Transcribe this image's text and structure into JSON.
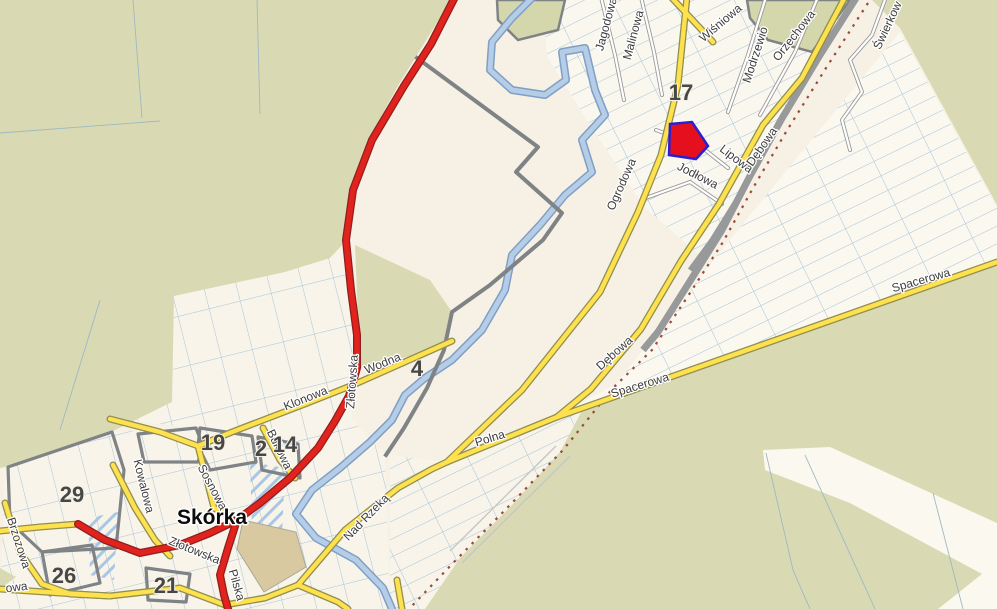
{
  "map": {
    "town": "Skórka",
    "streets": {
      "jagodowa": "Jagodowa",
      "malinowa": "Malinowa",
      "wisniowa": "Wiśniowa",
      "modrzewiowa": "Modrzewio",
      "orzechowa": "Orzechowa",
      "swierkowa": "Świerkow",
      "ogrodowa_upper": "Ogrodowa",
      "ogrodowa_lower": "Ogrodowa",
      "jodlowa": "Jodłowa",
      "lipowa": "Lipowa",
      "debowa_upper": "Dębowa",
      "debowa_lower": "Dębowa",
      "spacerowa_upper": "Spacerowa",
      "spacerowa_lower": "Spacerowa",
      "polna": "Polna",
      "nad_rzeka": "Nad Rzeką",
      "wodna": "Wodna",
      "klonowa": "Klonowa",
      "zlotowska_upper": "Złotowska",
      "zlotowska_lower": "Złotowska",
      "pilska": "Pilska",
      "kowalowa": "Kowalowa",
      "sosnowa": "Sosnowa",
      "bukowa": "Bukowa",
      "brzozowa": "Brzozowa",
      "partial_owa": "owa"
    },
    "area_numbers": {
      "n17": "17",
      "n4": "4",
      "n19": "19",
      "n2": "2",
      "n14": "14",
      "n29": "29",
      "n26": "26",
      "n21": "21"
    },
    "highlighted_parcel": {
      "fill": "#e60f1e",
      "stroke": "#2b1fd4"
    },
    "colors": {
      "background": "#f6f1e4",
      "fields": "#d9dab3",
      "road_major": "#e2231d",
      "road_secondary": "#ffe14d",
      "water": "#b5cde6",
      "railway": "#97999b",
      "railway_dashes": "#9a4a3a",
      "parcel_lines": "#a6c3d8",
      "boundary": "#7f8386",
      "label_text": "#3d3d3d",
      "building_area": "#d9c9a0"
    }
  }
}
